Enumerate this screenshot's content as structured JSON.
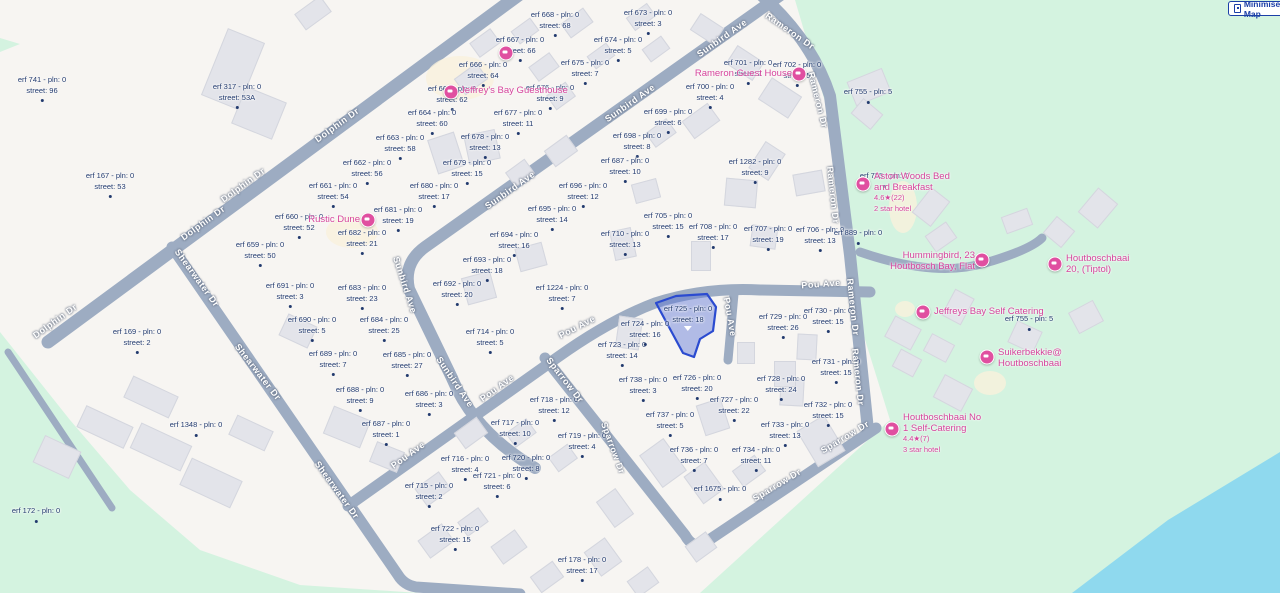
{
  "controls": {
    "minimise_label": "Minimise Map"
  },
  "colors": {
    "base": "#f7f5f2",
    "road": "#9dacc2",
    "green": "#d4f3e0",
    "water": "#8fd9ee",
    "building": "#e3e4ea",
    "label_navy": "#223a6e",
    "poi_pink": "#d6449c",
    "highlight_fill": "rgba(90,118,216,0.45)",
    "highlight_stroke": "#2b4bd0",
    "button_blue": "#1b3fa7"
  },
  "terrain": {
    "green_polys": [
      "795,0 845,170 862,330 890,420 700,593 1280,593 1280,0",
      "0,332 70,420 130,490 200,550 300,585 420,593 0,593",
      "0,38 20,44 0,52"
    ],
    "water_poly": "1280,452 1168,520 1072,593 1280,593",
    "cream_patches": [
      [
        460,
        78,
        34,
        22
      ],
      [
        352,
        232,
        26,
        16
      ],
      [
        903,
        207,
        14,
        26
      ],
      [
        990,
        383,
        16,
        12
      ],
      [
        905,
        309,
        10,
        8
      ]
    ]
  },
  "roads": [
    {
      "name": "dolphin-dr",
      "d": "M520,-6 L48,342",
      "w": 13
    },
    {
      "name": "dolphin-dr-ext",
      "d": "M8,352 Q60,430 112,508",
      "w": 7
    },
    {
      "name": "shearwater-dr",
      "d": "M172,247 L398,575 Q404,585 416,587 L520,594",
      "w": 11
    },
    {
      "name": "sunbird-ave",
      "d": "M782,-6 L425,247 Q403,263 409,289 L452,378 Q474,432 535,468",
      "w": 12
    },
    {
      "name": "pou-ave",
      "d": "M348,506 L558,357 Q610,320 655,303 Q705,287 760,290 L870,292",
      "w": 11
    },
    {
      "name": "pou-ave-spur",
      "d": "M734,294 L728,360",
      "w": 9
    },
    {
      "name": "sparrow-dr",
      "d": "M545,358 L685,535 Q692,548 703,544 L876,428",
      "w": 11
    },
    {
      "name": "rameron-dr",
      "d": "M760,-6 Q812,40 830,96 L850,255 L868,430",
      "w": 12
    },
    {
      "name": "rameron-connector",
      "d": "M860,252 Q935,278 985,263 Q1030,250 1042,238",
      "w": 9
    }
  ],
  "buildings": [
    [
      232,
      68,
      38,
      70,
      22
    ],
    [
      258,
      112,
      42,
      38,
      22
    ],
    [
      312,
      12,
      30,
      18,
      -36
    ],
    [
      484,
      42,
      24,
      16,
      -36
    ],
    [
      524,
      30,
      22,
      14,
      -36
    ],
    [
      576,
      22,
      26,
      16,
      -36
    ],
    [
      640,
      16,
      24,
      14,
      -36
    ],
    [
      470,
      78,
      26,
      18,
      -36
    ],
    [
      543,
      66,
      24,
      16,
      -36
    ],
    [
      600,
      55,
      22,
      14,
      -36
    ],
    [
      655,
      48,
      22,
      14,
      -36
    ],
    [
      445,
      152,
      26,
      34,
      -18
    ],
    [
      481,
      146,
      30,
      28,
      -12
    ],
    [
      519,
      172,
      22,
      16,
      -36
    ],
    [
      560,
      95,
      22,
      16,
      -36
    ],
    [
      706,
      28,
      26,
      18,
      33
    ],
    [
      744,
      62,
      30,
      20,
      33
    ],
    [
      779,
      97,
      34,
      24,
      33
    ],
    [
      700,
      120,
      30,
      20,
      -36
    ],
    [
      660,
      132,
      24,
      16,
      -36
    ],
    [
      766,
      160,
      22,
      30,
      33
    ],
    [
      740,
      192,
      30,
      26,
      5
    ],
    [
      763,
      236,
      24,
      20,
      8
    ],
    [
      700,
      255,
      18,
      28,
      0
    ],
    [
      645,
      190,
      24,
      18,
      -15
    ],
    [
      622,
      243,
      20,
      28,
      -12
    ],
    [
      530,
      256,
      26,
      22,
      -15
    ],
    [
      478,
      287,
      28,
      26,
      -15
    ],
    [
      560,
      150,
      26,
      18,
      -36
    ],
    [
      868,
      86,
      36,
      24,
      -22
    ],
    [
      866,
      113,
      24,
      18,
      40
    ],
    [
      808,
      182,
      20,
      28,
      80
    ],
    [
      1016,
      220,
      26,
      16,
      -20
    ],
    [
      1058,
      231,
      22,
      20,
      40
    ],
    [
      1097,
      207,
      24,
      30,
      40
    ],
    [
      940,
      236,
      24,
      18,
      -35
    ],
    [
      930,
      206,
      22,
      30,
      38
    ],
    [
      902,
      332,
      28,
      22,
      28
    ],
    [
      938,
      347,
      24,
      18,
      28
    ],
    [
      906,
      362,
      22,
      18,
      28
    ],
    [
      957,
      306,
      20,
      28,
      28
    ],
    [
      1024,
      336,
      26,
      22,
      25
    ],
    [
      1085,
      316,
      26,
      22,
      -28
    ],
    [
      952,
      392,
      30,
      24,
      28
    ],
    [
      628,
      332,
      22,
      30,
      8
    ],
    [
      712,
      416,
      24,
      30,
      -18
    ],
    [
      791,
      391,
      22,
      26,
      3
    ],
    [
      806,
      346,
      18,
      24,
      3
    ],
    [
      745,
      352,
      16,
      20,
      0
    ],
    [
      104,
      426,
      50,
      22,
      25
    ],
    [
      160,
      446,
      54,
      26,
      25
    ],
    [
      56,
      456,
      38,
      28,
      25
    ],
    [
      210,
      482,
      54,
      28,
      25
    ],
    [
      150,
      396,
      48,
      22,
      25
    ],
    [
      250,
      432,
      38,
      20,
      25
    ],
    [
      297,
      330,
      30,
      22,
      25
    ],
    [
      346,
      426,
      38,
      28,
      22
    ],
    [
      386,
      456,
      28,
      20,
      22
    ],
    [
      432,
      488,
      28,
      20,
      -36
    ],
    [
      470,
      432,
      26,
      18,
      -36
    ],
    [
      520,
      432,
      24,
      16,
      -36
    ],
    [
      562,
      457,
      22,
      16,
      -36
    ],
    [
      435,
      540,
      28,
      20,
      -36
    ],
    [
      472,
      521,
      24,
      16,
      -36
    ],
    [
      508,
      546,
      28,
      20,
      -36
    ],
    [
      546,
      576,
      26,
      18,
      -36
    ],
    [
      602,
      556,
      24,
      28,
      -36
    ],
    [
      642,
      581,
      24,
      18,
      -36
    ],
    [
      614,
      507,
      22,
      30,
      -36
    ],
    [
      700,
      546,
      24,
      18,
      -36
    ],
    [
      662,
      462,
      28,
      38,
      -36
    ],
    [
      703,
      482,
      24,
      32,
      -36
    ],
    [
      748,
      470,
      26,
      18,
      -36
    ],
    [
      820,
      440,
      30,
      40,
      -31
    ],
    [
      784,
      373,
      20,
      24,
      0
    ]
  ],
  "highlight": {
    "points": "656,303 676,296 707,294 716,307 713,331 700,339 694,357 683,353",
    "erf": "725"
  },
  "parcels": [
    [
      555,
      10,
      "erf 668 - pln: 0",
      "street: 68"
    ],
    [
      648,
      8,
      "erf 673 - pln: 0",
      "street: 3"
    ],
    [
      520,
      35,
      "erf 667 - pln: 0",
      "street: 66"
    ],
    [
      618,
      35,
      "erf 674 - pln: 0",
      "street: 5"
    ],
    [
      483,
      60,
      "erf 666 - pln: 0",
      "street: 64"
    ],
    [
      585,
      58,
      "erf 675 - pln: 0",
      "street: 7"
    ],
    [
      748,
      58,
      "erf 701 - pln: 0",
      "street: 2"
    ],
    [
      797,
      60,
      "erf 702 - pln: 0",
      "street: 5"
    ],
    [
      452,
      84,
      "erf 665 - pln: 0",
      "street: 62"
    ],
    [
      550,
      83,
      "erf 676 - pln: 0",
      "street: 9"
    ],
    [
      710,
      82,
      "erf 700 - pln: 0",
      "street: 4"
    ],
    [
      518,
      108,
      "erf 677 - pln: 0",
      "street: 11"
    ],
    [
      668,
      107,
      "erf 699 - pln: 0",
      "street: 6"
    ],
    [
      485,
      132,
      "erf 678 - pln: 0",
      "street: 13"
    ],
    [
      637,
      131,
      "erf 698 - pln: 0",
      "street: 8"
    ],
    [
      237,
      82,
      "erf 317 - pln: 0",
      "street: 53A"
    ],
    [
      42,
      75,
      "erf 741 - pln: 0",
      "street: 96"
    ],
    [
      432,
      108,
      "erf 664 - pln: 0",
      "street: 60"
    ],
    [
      400,
      133,
      "erf 663 - pln: 0",
      "street: 58"
    ],
    [
      367,
      158,
      "erf 662 - pln: 0",
      "street: 56"
    ],
    [
      467,
      158,
      "erf 679 - pln: 0",
      "street: 15"
    ],
    [
      625,
      156,
      "erf 687 - pln: 0",
      "street: 10"
    ],
    [
      755,
      157,
      "erf 1282 - pln: 0",
      "street: 9"
    ],
    [
      333,
      181,
      "erf 661 - pln: 0",
      "street: 54"
    ],
    [
      434,
      181,
      "erf 680 - pln: 0",
      "street: 17"
    ],
    [
      583,
      181,
      "erf 696 - pln: 0",
      "street: 12"
    ],
    [
      110,
      171,
      "erf 167 - pln: 0",
      "street: 53"
    ],
    [
      398,
      205,
      "erf 681 - pln: 0",
      "street: 19"
    ],
    [
      552,
      204,
      "erf 695 - pln: 0",
      "street: 14"
    ],
    [
      362,
      228,
      "erf 682 - pln: 0",
      "street: 21"
    ],
    [
      514,
      230,
      "erf 694 - pln: 0",
      "street: 16"
    ],
    [
      625,
      229,
      "erf 710 - pln: 0",
      "street: 13"
    ],
    [
      668,
      211,
      "erf 705 - pln: 0",
      "street: 15"
    ],
    [
      713,
      222,
      "erf 708 - pln: 0",
      "street: 17"
    ],
    [
      768,
      224,
      "erf 707 - pln: 0",
      "street: 19"
    ],
    [
      820,
      225,
      "erf 706 - pln: 0",
      "street: 13"
    ],
    [
      858,
      228,
      "erf 889 - pln: 0",
      null
    ],
    [
      868,
      87,
      "erf 755 - pln: 5",
      null
    ],
    [
      884,
      171,
      "erf 755 - pln: 7",
      null
    ],
    [
      1029,
      314,
      "erf 755 - pln: 5",
      null
    ],
    [
      299,
      212,
      "erf 660 - pln: 0",
      "street: 52"
    ],
    [
      260,
      240,
      "erf 659 - pln: 0",
      "street: 50"
    ],
    [
      290,
      281,
      "erf 691 - pln: 0",
      "street: 3"
    ],
    [
      312,
      315,
      "erf 690 - pln: 0",
      "street: 5"
    ],
    [
      362,
      283,
      "erf 683 - pln: 0",
      "street: 23"
    ],
    [
      384,
      315,
      "erf 684 - pln: 0",
      "street: 25"
    ],
    [
      137,
      327,
      "erf 169 - pln: 0",
      "street: 2"
    ],
    [
      487,
      255,
      "erf 693 - pln: 0",
      "street: 18"
    ],
    [
      457,
      279,
      "erf 692 - pln: 0",
      "street: 20"
    ],
    [
      562,
      283,
      "erf 1224 - pln: 0",
      "street: 7"
    ],
    [
      490,
      327,
      "erf 714 - pln: 0",
      "street: 5"
    ],
    [
      407,
      350,
      "erf 685 - pln: 0",
      "street: 27"
    ],
    [
      333,
      349,
      "erf 689 - pln: 0",
      "street: 7"
    ],
    [
      360,
      385,
      "erf 688 - pln: 0",
      "street: 9"
    ],
    [
      429,
      389,
      "erf 686 - pln: 0",
      "street: 3"
    ],
    [
      386,
      419,
      "erf 687 - pln: 0",
      "street: 1"
    ],
    [
      429,
      481,
      "erf 715 - pln: 0",
      "street: 2"
    ],
    [
      465,
      454,
      "erf 716 - pln: 0",
      "street: 4"
    ],
    [
      497,
      471,
      "erf 721 - pln: 0",
      "street: 6"
    ],
    [
      515,
      418,
      "erf 717 - pln: 0",
      "street: 10"
    ],
    [
      554,
      395,
      "erf 718 - pln: 0",
      "street: 12"
    ],
    [
      526,
      453,
      "erf 720 - pln: 0",
      "street: 8"
    ],
    [
      582,
      431,
      "erf 719 - pln: 0",
      "street: 4"
    ],
    [
      455,
      524,
      "erf 722 - pln: 0",
      "street: 15"
    ],
    [
      582,
      555,
      "erf 178 - pln: 0",
      "street: 17"
    ],
    [
      720,
      484,
      "erf 1675 - pln: 0",
      null
    ],
    [
      694,
      445,
      "erf 736 - pln: 0",
      "street: 7"
    ],
    [
      756,
      445,
      "erf 734 - pln: 0",
      "street: 11"
    ],
    [
      785,
      420,
      "erf 733 - pln: 0",
      "street: 13"
    ],
    [
      670,
      410,
      "erf 737 - pln: 0",
      "street: 5"
    ],
    [
      643,
      375,
      "erf 738 - pln: 0",
      "street: 3"
    ],
    [
      697,
      373,
      "erf 726 - pln: 0",
      "street: 20"
    ],
    [
      734,
      395,
      "erf 727 - pln: 0",
      "street: 22"
    ],
    [
      781,
      374,
      "erf 728 - pln: 0",
      "street: 24"
    ],
    [
      783,
      312,
      "erf 729 - pln: 0",
      "street: 26"
    ],
    [
      828,
      306,
      "erf 730 - pln: 0",
      "street: 15"
    ],
    [
      836,
      357,
      "erf 731 - pln: 0",
      "street: 15"
    ],
    [
      828,
      400,
      "erf 732 - pln: 0",
      "street: 15"
    ],
    [
      622,
      340,
      "erf 723 - pln: 0",
      "street: 14"
    ],
    [
      645,
      319,
      "erf 724 - pln: 0",
      "street: 16"
    ],
    [
      688,
      304,
      "erf 725 - pln: 0",
      "street: 18",
      "tri"
    ],
    [
      196,
      420,
      "erf 1348 - pln: 0",
      null
    ],
    [
      36,
      506,
      "erf 172 - pln: 0",
      null
    ]
  ],
  "street_labels": [
    [
      337,
      125,
      -36,
      "Dolphin Dr"
    ],
    [
      243,
      185,
      -36,
      "Dolphin Dr"
    ],
    [
      203,
      223,
      -36,
      "Dolphin Dr"
    ],
    [
      55,
      321,
      -36,
      "Dolphin Dr"
    ],
    [
      197,
      278,
      54,
      "Shearwater Dr"
    ],
    [
      258,
      372,
      52,
      "Shearwater Dr"
    ],
    [
      337,
      490,
      54,
      "Shearwater Dr"
    ],
    [
      722,
      38,
      -35,
      "Sunbird Ave"
    ],
    [
      630,
      103,
      -35,
      "Sunbird Ave"
    ],
    [
      510,
      190,
      -35,
      "Sunbird Ave"
    ],
    [
      405,
      285,
      72,
      "Sunbird Ave"
    ],
    [
      455,
      382,
      56,
      "Sunbird Ave"
    ],
    [
      408,
      455,
      -36,
      "Pou Ave"
    ],
    [
      497,
      388,
      -36,
      "Pou Ave"
    ],
    [
      577,
      327,
      -27,
      "Pou Ave"
    ],
    [
      730,
      317,
      80,
      "Pou Ave"
    ],
    [
      821,
      284,
      -4,
      "Pou Ave"
    ],
    [
      565,
      380,
      52,
      "Sparrow Dr"
    ],
    [
      613,
      448,
      70,
      "Sparrow Dr"
    ],
    [
      777,
      485,
      -31,
      "Sparrow Dr"
    ],
    [
      845,
      437,
      -31,
      "Sparrow Dr"
    ],
    [
      790,
      31,
      35,
      "Rameron Dr"
    ],
    [
      818,
      100,
      76,
      "Rameron Dr"
    ],
    [
      833,
      195,
      84,
      "Rameron Dr"
    ],
    [
      853,
      307,
      84,
      "Rameron Dr"
    ],
    [
      858,
      377,
      84,
      "Rameron Dr"
    ]
  ],
  "pois": [
    {
      "id": "bnb-dot",
      "icon": [
        506,
        53
      ],
      "text": null
    },
    {
      "id": "jeffreys-bay-guesthouse",
      "icon": [
        451,
        92
      ],
      "text": {
        "x": 460,
        "y": 86,
        "align": "left",
        "lines": [
          {
            "t": "Jeffrey's Bay Guesthouse",
            "c": "pink"
          }
        ]
      }
    },
    {
      "id": "rameron-guest-house",
      "icon": [
        799,
        74
      ],
      "text": {
        "x": 792,
        "y": 69,
        "align": "right",
        "lines": [
          {
            "t": "Rameron Guest House",
            "c": "pink"
          }
        ]
      }
    },
    {
      "id": "rustic-dune",
      "icon": [
        368,
        220
      ],
      "text": {
        "x": 360,
        "y": 215,
        "align": "right",
        "lines": [
          {
            "t": "Rustic Dune",
            "c": "pink"
          }
        ]
      }
    },
    {
      "id": "aston-woods",
      "icon": [
        863,
        184
      ],
      "text": {
        "x": 874,
        "y": 172,
        "align": "left",
        "lines": [
          {
            "t": "Aston Woods Bed",
            "c": "pink"
          },
          {
            "t": "and Breakfast",
            "c": "pink"
          },
          {
            "t": "4.6★(22)",
            "c": "small"
          },
          {
            "t": "2 star hotel",
            "c": "small"
          }
        ]
      }
    },
    {
      "id": "hummingbird",
      "icon": [
        982,
        260
      ],
      "text": {
        "x": 975,
        "y": 251,
        "align": "right",
        "lines": [
          {
            "t": "Hummingbird, 23",
            "c": "pink"
          },
          {
            "t": "Houtbosch Bay, Flat",
            "c": "pink"
          }
        ]
      }
    },
    {
      "id": "houtboschbaai-20",
      "icon": [
        1055,
        264
      ],
      "text": {
        "x": 1066,
        "y": 254,
        "align": "left",
        "lines": [
          {
            "t": "Houtboschbaai",
            "c": "pink"
          },
          {
            "t": "20, (Tiptol)",
            "c": "pink"
          }
        ]
      }
    },
    {
      "id": "jeffreys-bay-self-catering",
      "icon": [
        923,
        312
      ],
      "text": {
        "x": 934,
        "y": 307,
        "align": "left",
        "lines": [
          {
            "t": "Jeffreys Bay Self Catering",
            "c": "pink"
          }
        ]
      }
    },
    {
      "id": "suikerbekkie",
      "icon": [
        987,
        357
      ],
      "text": {
        "x": 998,
        "y": 348,
        "align": "left",
        "lines": [
          {
            "t": "Suikerbekkie@",
            "c": "pink"
          },
          {
            "t": "Houtboschbaai",
            "c": "pink"
          }
        ]
      }
    },
    {
      "id": "houtboschbaai-no1",
      "icon": [
        892,
        429
      ],
      "text": {
        "x": 903,
        "y": 413,
        "align": "left",
        "lines": [
          {
            "t": "Houtboschbaai No",
            "c": "pink"
          },
          {
            "t": "1 Self-Catering",
            "c": "pink"
          },
          {
            "t": "4.4★(7)",
            "c": "small"
          },
          {
            "t": "3 star hotel",
            "c": "small"
          }
        ]
      }
    }
  ]
}
